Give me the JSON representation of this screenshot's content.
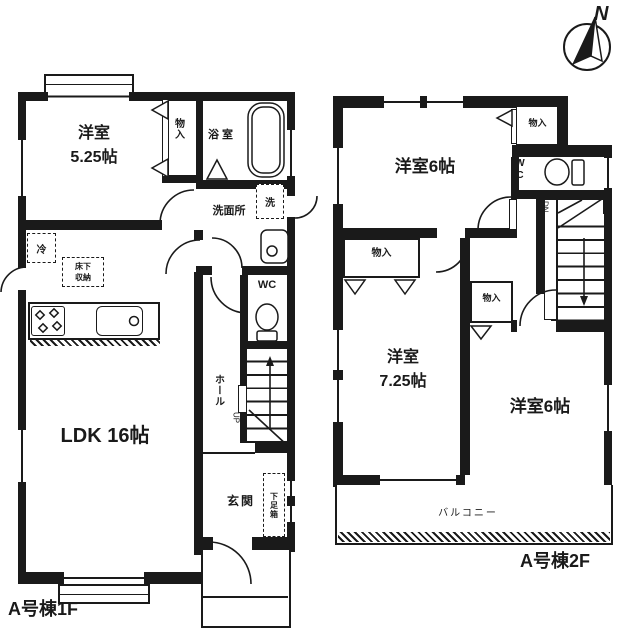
{
  "page": {
    "background": "#ffffff",
    "ink": "#1a1a1a"
  },
  "compass": {
    "label": "N"
  },
  "floor1": {
    "caption": "A号棟1F",
    "bedroom": {
      "name": "洋室",
      "size": "5.25帖"
    },
    "closet": "物入",
    "bath": "浴室",
    "washroom": "洗面所",
    "washer": "洗",
    "fridge": "冷",
    "underfloor_line1": "床下",
    "underfloor_line2": "収納",
    "ldk": "LDK 16帖",
    "wc": "WC",
    "hall": "ホール",
    "stairs_direction": "UP",
    "entrance": "玄関",
    "shoe_box": "下足箱"
  },
  "floor2": {
    "caption": "A号棟2F",
    "bedroom_north": "洋室6帖",
    "closet_north": "物入",
    "wc": "WC",
    "stairs_direction": "DN",
    "closet_west": "物入",
    "bedroom_west": {
      "name": "洋室",
      "size": "7.25帖"
    },
    "closet_center": "物入",
    "bedroom_southeast": "洋室6帖",
    "balcony": "バルコニー"
  }
}
